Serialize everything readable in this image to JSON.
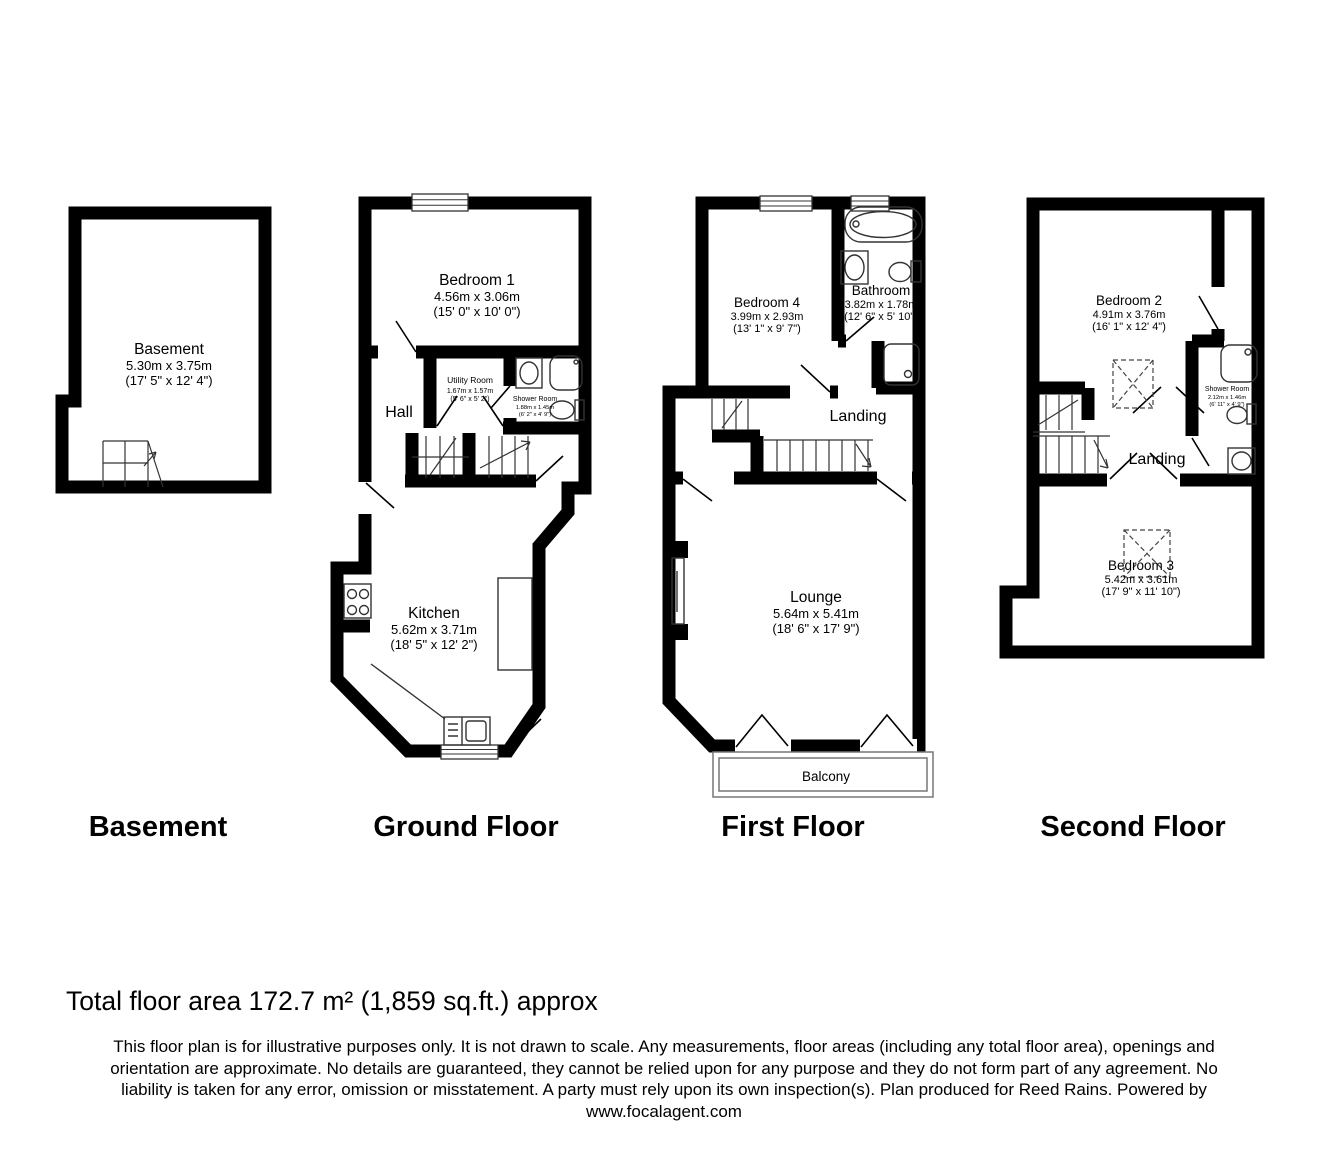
{
  "meta": {
    "colors": {
      "wall": "#000000",
      "background": "#ffffff"
    }
  },
  "floors": {
    "basement": {
      "title": "Basement",
      "room": {
        "name": "Basement",
        "metric": "5.30m x 3.75m",
        "imperial": "(17' 5\" x 12' 4\")"
      }
    },
    "ground": {
      "title": "Ground Floor",
      "bedroom1": {
        "name": "Bedroom 1",
        "metric": "4.56m x 3.06m",
        "imperial": "(15' 0\" x 10' 0\")"
      },
      "utility": {
        "name": "Utility Room",
        "metric": "1.67m x 1.57m",
        "imperial": "(5' 6\" x 5' 2\")"
      },
      "shower": {
        "name": "Shower Room",
        "metric": "1.88m x 1.45m",
        "imperial": "(6' 2\" x 4' 9\")"
      },
      "hall": {
        "name": "Hall"
      },
      "kitchen": {
        "name": "Kitchen",
        "metric": "5.62m x 3.71m",
        "imperial": "(18' 5\" x 12' 2\")"
      }
    },
    "first": {
      "title": "First Floor",
      "bedroom4": {
        "name": "Bedroom 4",
        "metric": "3.99m x 2.93m",
        "imperial": "(13' 1\" x 9' 7\")"
      },
      "bathroom": {
        "name": "Bathroom",
        "metric": "3.82m x 1.78m",
        "imperial": "(12' 6\" x 5' 10\")"
      },
      "landing": {
        "name": "Landing"
      },
      "lounge": {
        "name": "Lounge",
        "metric": "5.64m x 5.41m",
        "imperial": "(18' 6\" x 17' 9\")"
      },
      "balcony": {
        "name": "Balcony"
      }
    },
    "second": {
      "title": "Second Floor",
      "bedroom2": {
        "name": "Bedroom 2",
        "metric": "4.91m x 3.76m",
        "imperial": "(16' 1\" x 12' 4\")"
      },
      "shower": {
        "name": "Shower Room",
        "metric": "2.12m x 1.46m",
        "imperial": "(6' 11\" x 4' 9\")"
      },
      "landing": {
        "name": "Landing"
      },
      "bedroom3": {
        "name": "Bedroom 3",
        "metric": "5.42m x 3.61m",
        "imperial": "(17' 9\" x 11' 10\")"
      }
    }
  },
  "footer": {
    "total_area": "Total floor area 172.7 m² (1,859 sq.ft.) approx",
    "disclaimer_lines": [
      "This floor plan is for illustrative purposes only. It is not drawn to scale. Any measurements, floor areas (including any total floor area), openings and",
      "orientation are approximate. No details are guaranteed, they cannot be relied upon for any purpose and they do not form part of any agreement. No",
      "liability is taken for any error, omission or misstatement. A party must rely upon its own inspection(s). Plan produced for Reed Rains. Powered by",
      "www.focalagent.com"
    ]
  }
}
